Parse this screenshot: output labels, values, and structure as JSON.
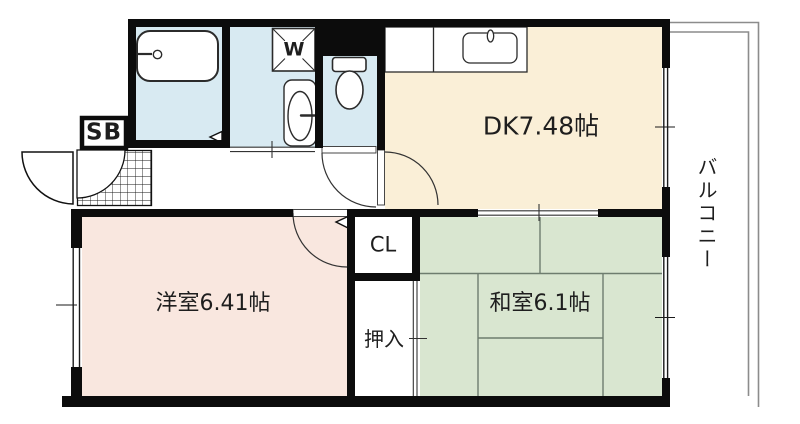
{
  "floorplan": {
    "title": "1DK+2room apartment floor plan",
    "rooms": {
      "dk": {
        "label": "DK7.48帖"
      },
      "western_room": {
        "label": "洋室6.41帖"
      },
      "japanese_room": {
        "label": "和室6.1帖"
      },
      "balcony": {
        "label": "バルコニー"
      },
      "closet": {
        "label": "CL"
      },
      "futon_closet": {
        "label": "押入"
      },
      "shoe_box": {
        "label": "SB"
      },
      "washing_machine": {
        "label": "W"
      }
    },
    "colors": {
      "wet_area": "#D8EAF2",
      "dk": "#FAEFD7",
      "western_room": "#F9E7DF",
      "japanese_room": "#D9E6D0",
      "wall": "#0c0c0c",
      "fixture_line": "#2b2b2b",
      "tatami_line": "#6e7d6e",
      "balcony_line": "#8c8c8c"
    }
  }
}
